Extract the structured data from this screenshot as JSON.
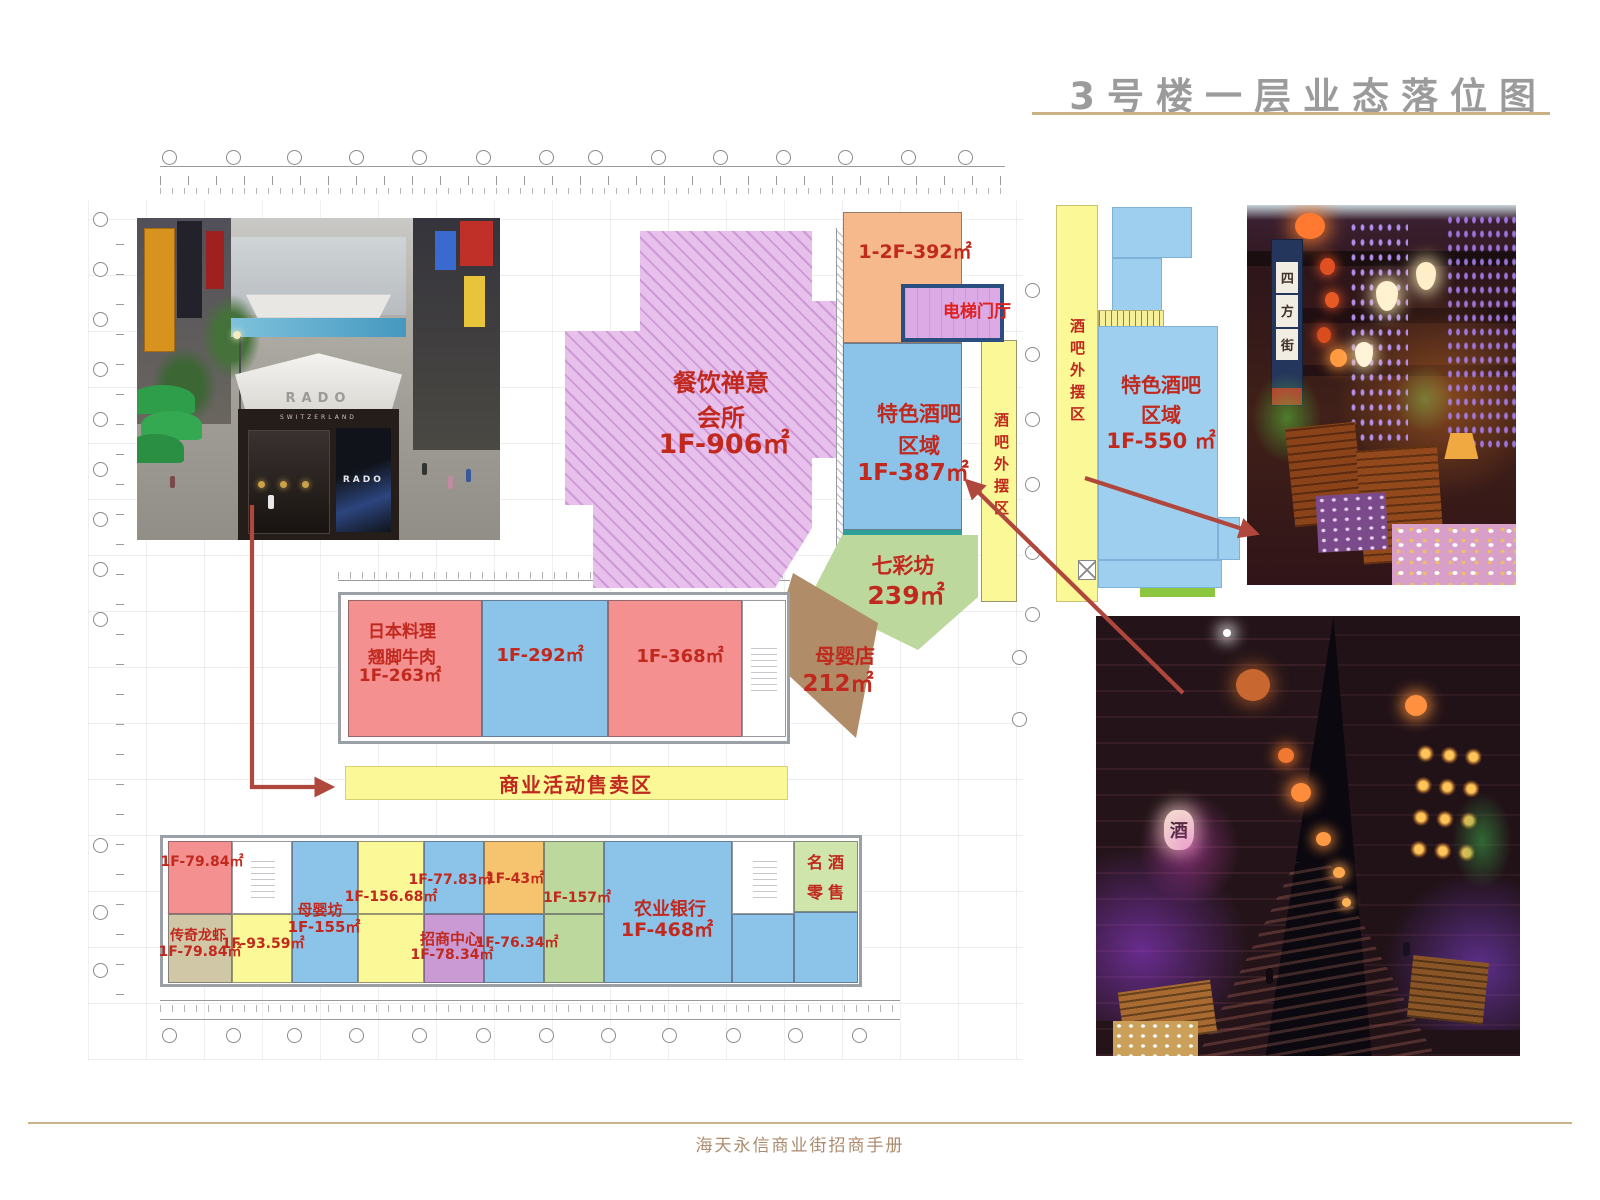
{
  "page": {
    "title": "3号楼一层业态落位图",
    "footer": "海天永信商业街招商手册"
  },
  "plan": {
    "zones": {
      "chanyi": {
        "name": "餐饮禅意\n会所",
        "area": "1F-906㎡",
        "color": "#e7c0ec"
      },
      "f392": {
        "area": "1-2F-392㎡",
        "color": "#f5b98b"
      },
      "elevator": {
        "name": "电梯门厅",
        "fill": "#dcaae4",
        "border": "#2b4e80"
      },
      "bar387": {
        "name": "特色酒吧\n区域",
        "area": "1F-387㎡",
        "color": "#8cc3e9"
      },
      "waibai": {
        "name": "酒吧外摆区",
        "color": "#fbf897"
      },
      "qicai": {
        "name": "七彩坊",
        "area": "239㎡",
        "color": "#bdd89c"
      },
      "muyingdian": {
        "name": "母婴店",
        "area": "212㎡",
        "color": "#b08d68"
      },
      "riben": {
        "name": "日本料理\n翘脚牛肉",
        "area": "1F-263㎡",
        "color": "#f49190"
      },
      "f292": {
        "area": "1F-292㎡",
        "color": "#8cc3e9"
      },
      "f368": {
        "area": "1F-368㎡",
        "color": "#f49190"
      },
      "huodong": {
        "name": "商业活动售卖区",
        "color": "#fbf897"
      },
      "u7984a": {
        "area": "1F-79.84㎡",
        "color": "#f49190"
      },
      "muyingfang": {
        "name": "母婴坊",
        "area": "1F-155㎡",
        "color": "#8cc3e9"
      },
      "u15668": {
        "area": "1F-156.68㎡",
        "color": "#fbf897"
      },
      "u7783": {
        "area": "1F-77.83㎡",
        "color": "#8cc3e9"
      },
      "u43": {
        "area": "1F-43㎡",
        "color": "#f6c46e"
      },
      "u157": {
        "area": "1F-157㎡",
        "color": "#bdd89c"
      },
      "nongye": {
        "name": "农业银行",
        "area": "1F-468㎡",
        "color": "#8cc3e9"
      },
      "mingjiu": {
        "name": "名酒\n零售",
        "color": "#cfe5ab"
      },
      "chuanqi": {
        "name": "传奇龙虾",
        "area": "1F-79.84㎡",
        "color": "#d0c7a6"
      },
      "u9359": {
        "area": "1F-93.59㎡",
        "color": "#fbf897"
      },
      "zhaoshang": {
        "name": "招商中心",
        "area": "1F-78.34㎡",
        "color": "#c99ad3"
      },
      "u7634": {
        "area": "1F-76.34㎡",
        "color": "#8cc3e9"
      }
    }
  },
  "plan2": {
    "waibai": "酒吧外摆区",
    "name": "特色酒吧\n区域",
    "area": "1F-550 ㎡",
    "zone_color": "#9fcfef",
    "strip_color": "#fbf897"
  },
  "photos": {
    "street": {
      "awning_brand": "RADO",
      "kiosk_sub": "SWITZERLAND",
      "panel_brand": "RADO"
    },
    "courtyard": {
      "banner_char_1": "四",
      "banner_char_2": "方",
      "banner_char_3": "街"
    },
    "alley": {
      "lantern_char": "酒"
    }
  },
  "colors": {
    "label_red": "#c1281e",
    "title_gray": "#9b9b9b",
    "gold_line": "#c9b183",
    "arrow_red": "#b0473d",
    "footer_text": "#ac8b6d"
  }
}
